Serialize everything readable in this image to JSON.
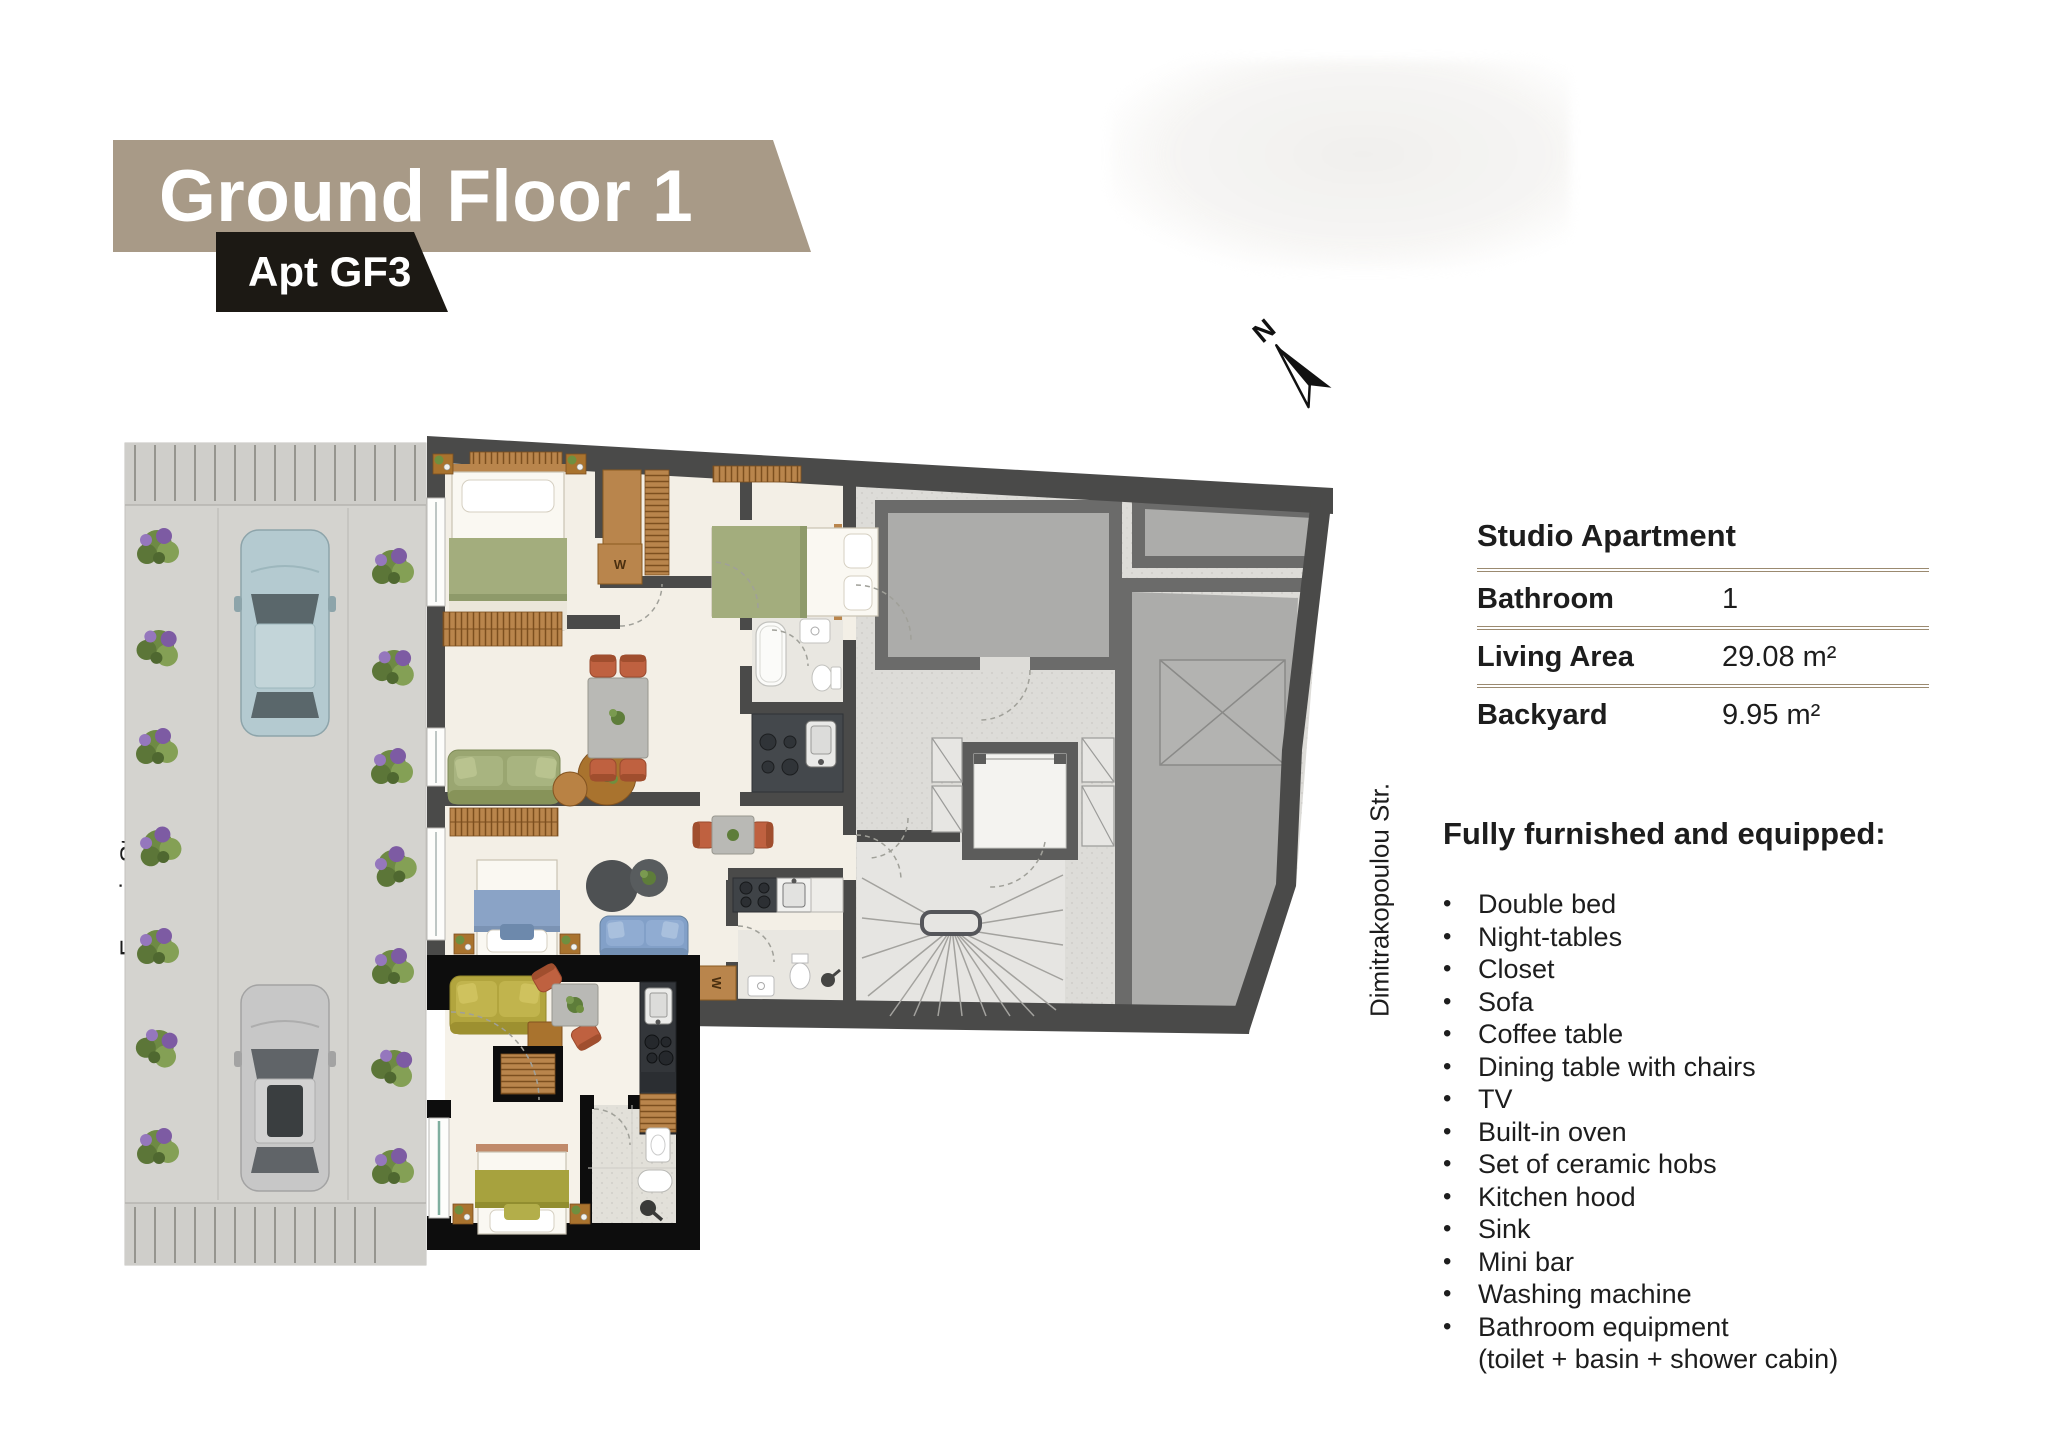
{
  "header": {
    "title": "Ground Floor 1",
    "apartment_badge": "Apt GF3"
  },
  "compass": {
    "north_label": "N"
  },
  "streets": {
    "left_street": "Evropis Str.",
    "right_street": "Dimitrakopoulou Str."
  },
  "info_table": {
    "header": "Studio Apartment",
    "rows": [
      {
        "label": "Bathroom",
        "value": "1"
      },
      {
        "label": "Living Area",
        "value": "29.08 m²"
      },
      {
        "label": "Backyard",
        "value": "9.95 m²"
      }
    ]
  },
  "furnished": {
    "heading": "Fully furnished and equipped:",
    "items": [
      "Double bed",
      "Night-tables",
      "Closet",
      "Sofa",
      "Coffee table",
      "Dining table with chairs",
      "TV",
      "Built-in oven",
      "Set of ceramic hobs",
      "Kitchen hood",
      "Sink",
      "Mini bar",
      "Washing machine",
      "Bathroom equipment"
    ],
    "last_item_note": "(toilet + basin + shower cabin)"
  },
  "floorplan": {
    "wardrobe_label": "W"
  },
  "colors": {
    "banner_bg": "#a89a87",
    "badge_bg": "#1c1914",
    "table_line": "#9b8a70",
    "text": "#1d1d1d",
    "plan_wall": "#4a4a49",
    "gf3_highlight_wall": "#0d0d0d",
    "apartment_floor": "#f3efe6",
    "communal_floor": "#dddcd8",
    "gray_room": "#acacaa",
    "accent_green_sofa": "#9aa671",
    "accent_blue": "#82a0c8",
    "accent_olive": "#b2a53e",
    "accent_orange_chair": "#bf6140",
    "bush_green": "#6e8a44",
    "bush_purple": "#7d5ba3",
    "car_teal": "#b4cad0",
    "car_silver": "#c7c7c7"
  }
}
